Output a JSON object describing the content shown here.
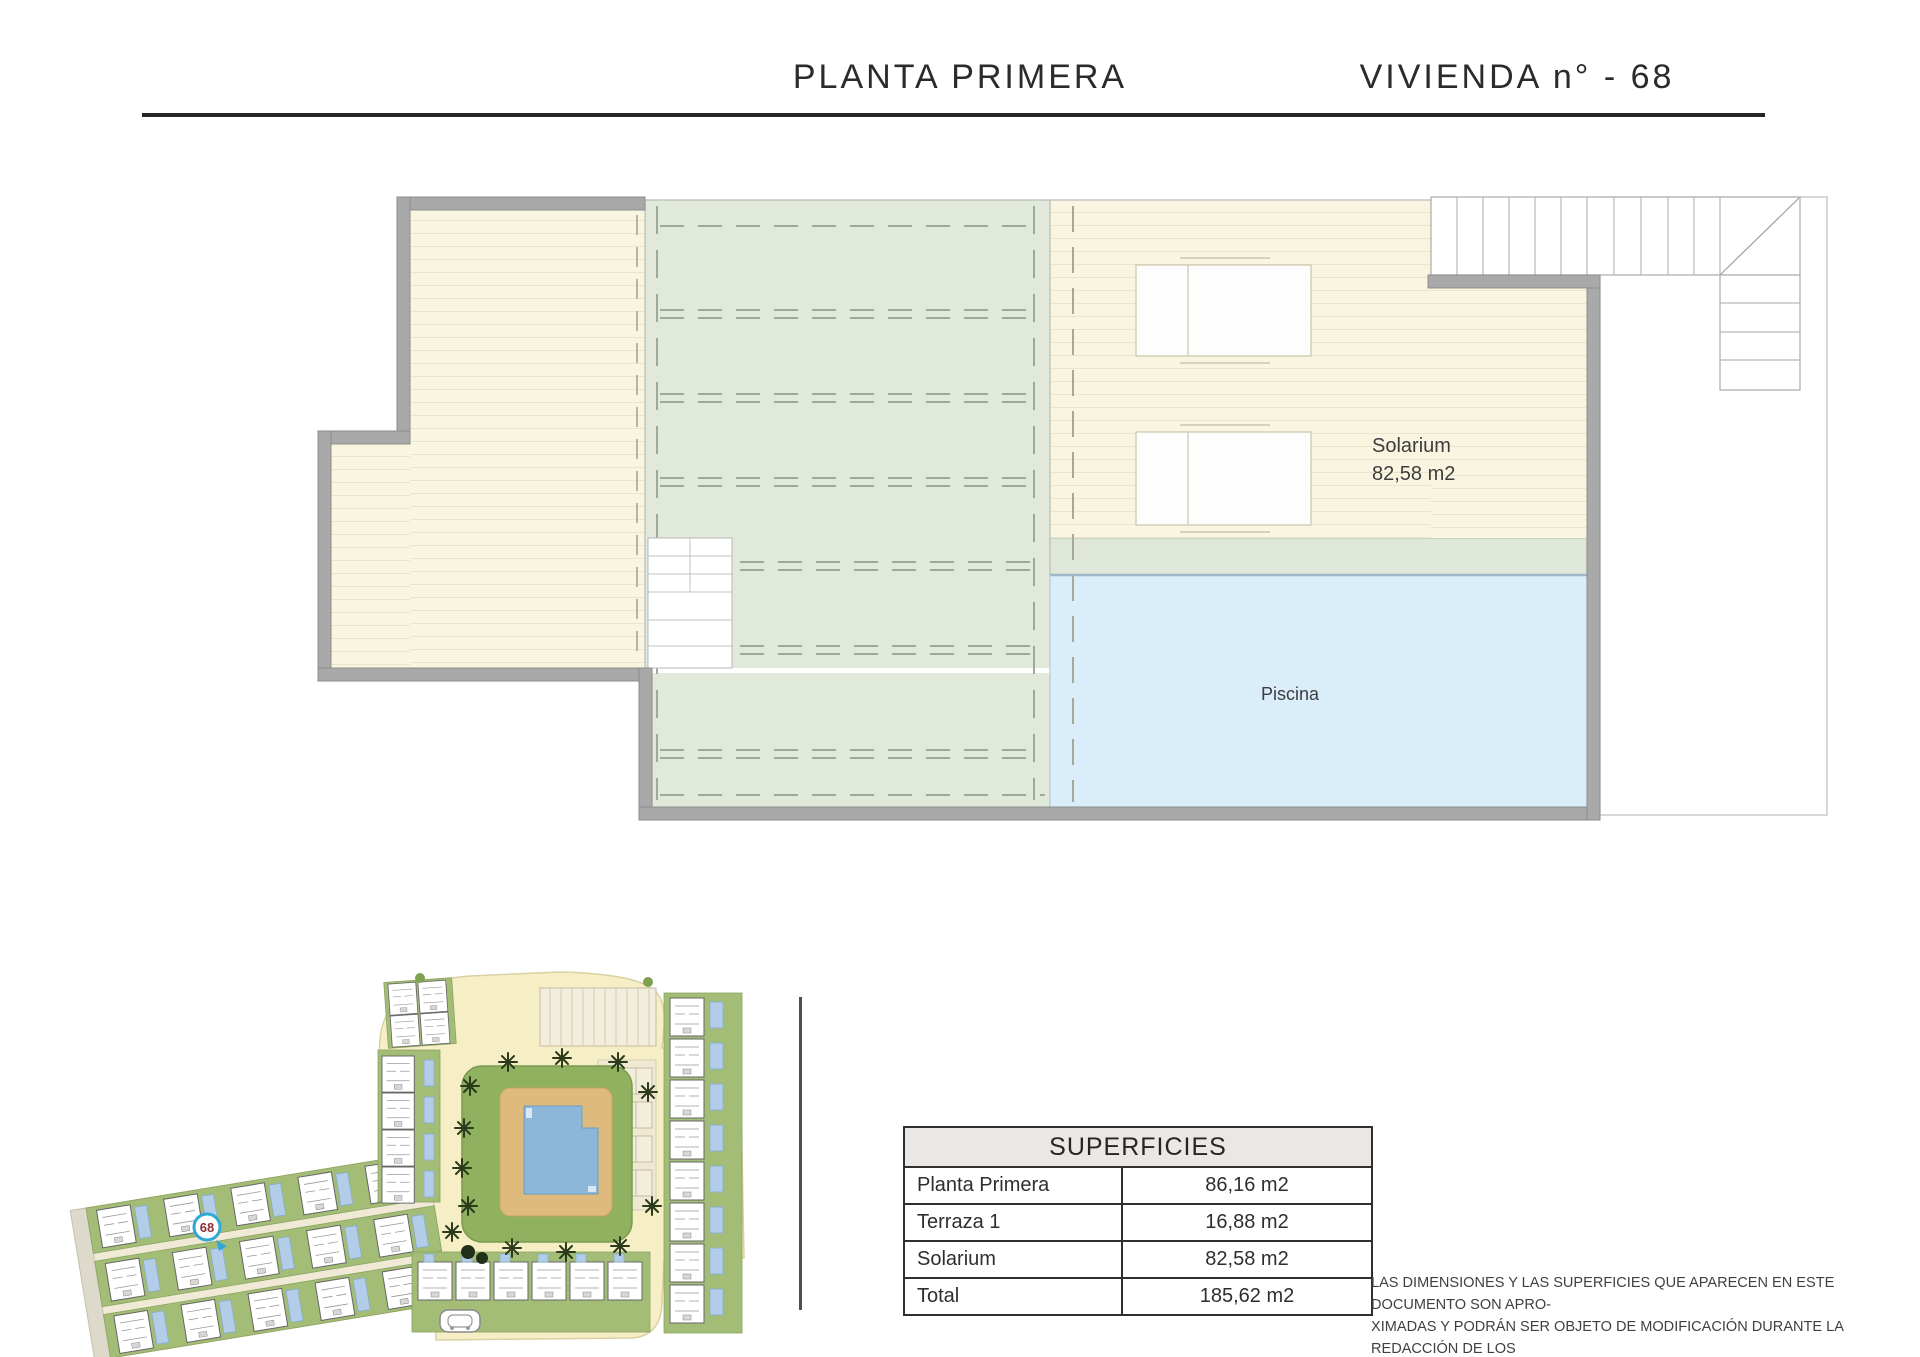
{
  "header": {
    "left_title": "PLANTA PRIMERA",
    "right_title": "VIVIENDA n° - 68"
  },
  "plan": {
    "solarium_label": "Solarium",
    "solarium_area": "82,58 m2",
    "piscina_label": "Piscina"
  },
  "site_plan": {
    "unit_badge": "68"
  },
  "table": {
    "header": "SUPERFICIES",
    "rows": [
      {
        "label": "Planta Primera",
        "value": "86,16 m2"
      },
      {
        "label": "Terraza 1",
        "value": "16,88 m2"
      },
      {
        "label": "Solarium",
        "value": "82,58 m2"
      },
      {
        "label": "Total",
        "value": "185,62 m2"
      }
    ]
  },
  "disclaimer": "LAS DIMENSIONES Y LAS SUPERFICIES QUE APARECEN EN ESTE DOCUMENTO SON APRO-\nXIMADAS Y PODRÁN SER OBJETO DE MODIFICACIÓN DURANTE LA REDACCIÓN DE LOS\nPROYECTOS BÁSICO Y DE EJECUCIÓN",
  "colors": {
    "wall": "#a9a9a9",
    "deck_cream": "#faf5e1",
    "pergola_green": "#e0e9da",
    "pool_blue": "#daedfa",
    "site_building_green": "#a3bd77",
    "site_road_cream": "#f6efc6",
    "badge_ring_blue": "#2fa8d5",
    "badge_number_red": "#8d2f2f"
  }
}
